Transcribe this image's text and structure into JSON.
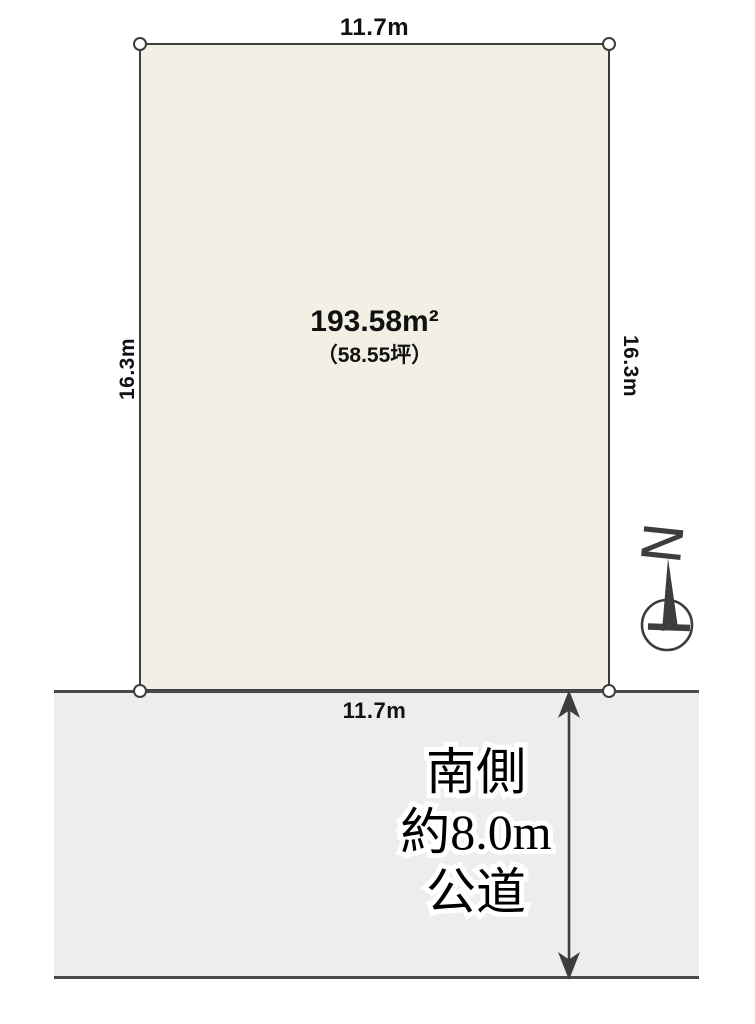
{
  "colors": {
    "plot_fill": "#f2efe4",
    "road_fill": "#ededed",
    "line": "#3d3d3d",
    "label_text": "#111111",
    "label_halo": "#ffffff"
  },
  "plot": {
    "area_label": "193.58m²",
    "area_sub_label": "（58.55坪）",
    "dim_top": "11.7m",
    "dim_bottom": "11.7m",
    "dim_left": "16.3m",
    "dim_right": "16.3m"
  },
  "road": {
    "label_line1": "南側",
    "label_line2": "約8.0m",
    "label_line3": "公道"
  },
  "compass": {
    "north_label": "N"
  }
}
